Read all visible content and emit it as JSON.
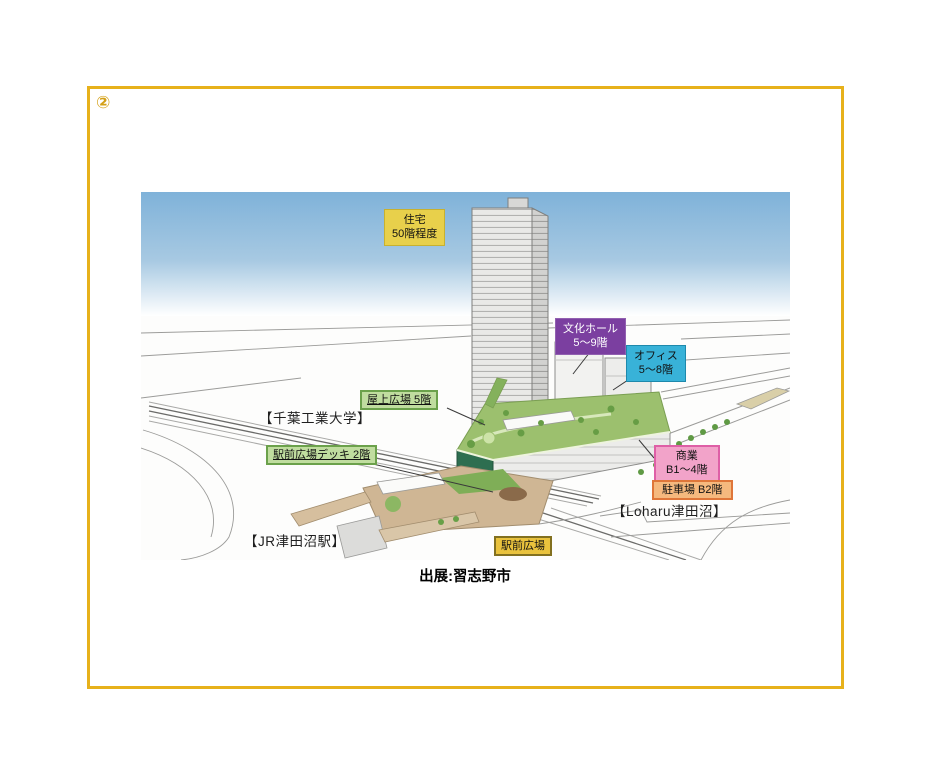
{
  "page": {
    "number_marker": "②",
    "caption": "出展:習志野市"
  },
  "colors": {
    "frame_gold": "#E7B11B",
    "marker_gold": "#D4A017",
    "sky_top": "#7FB2D9",
    "housing_bg": "#E8D04B",
    "culture_hall_bg": "#7B3FA0",
    "office_bg": "#38B2D8",
    "green_label_bg": "#C0DD9F",
    "green_label_border": "#6BA14B",
    "commercial_bg": "#F2A3C9",
    "commercial_border": "#DE5FA6",
    "parking_bg": "#F5B97E",
    "parking_border": "#DF7639",
    "station_plaza_bg": "#E9C23D",
    "roof_garden_green": "#9CC06E",
    "deck_tan": "#CFB694"
  },
  "figure": {
    "labels": {
      "housing": {
        "line1": "住宅",
        "line2": "50階程度"
      },
      "culture_hall": {
        "line1": "文化ホール",
        "line2": "5〜9階"
      },
      "office": {
        "line1": "オフィス",
        "line2": "5〜8階"
      },
      "rooftop_plaza": {
        "text": "屋上広場 5階"
      },
      "station_deck": {
        "text": "駅前広場デッキ 2階"
      },
      "commercial": {
        "line1": "商業",
        "line2": "B1〜4階"
      },
      "parking": {
        "text": "駐車場 B2階"
      },
      "station_plaza": {
        "text": "駅前広場"
      }
    },
    "landmarks": {
      "chiba_tech": "【千葉工業大学】",
      "loharu": "【Loharu津田沼】",
      "jr_station": "【JR津田沼駅】"
    }
  }
}
